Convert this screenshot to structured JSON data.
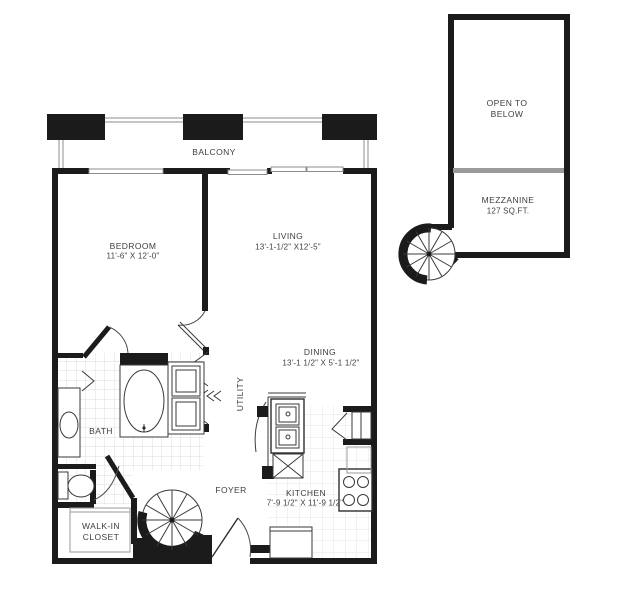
{
  "plan": {
    "rooms": {
      "balcony": {
        "label": "BALCONY"
      },
      "bedroom": {
        "label": "BEDROOM",
        "dims": "11'-6\" X 12'-0\""
      },
      "living": {
        "label": "LIVING",
        "dims": "13'-1-1/2\" X12'-5\""
      },
      "dining": {
        "label": "DINING",
        "dims": "13'-1 1/2\" X 5'-1 1/2\""
      },
      "utility": {
        "label": "UTILITY"
      },
      "bath": {
        "label": "BATH"
      },
      "foyer": {
        "label": "FOYER"
      },
      "kitchen": {
        "label": "KITCHEN",
        "dims": "7'-9 1/2\" X 11'-9 1/2\""
      },
      "walk_in_closet": {
        "label_line1": "WALK-IN",
        "label_line2": "CLOSET"
      },
      "open_to_below": {
        "label_line1": "OPEN TO",
        "label_line2": "BELOW"
      },
      "mezzanine": {
        "label": "MEZZANINE",
        "area": "127 SQ.FT."
      }
    },
    "colors": {
      "wall": "#1b1b1b",
      "window_line": "#8d8d8d",
      "tile_line": "#dcdcdc",
      "kitchen_tile_line": "#e6e6e6",
      "divider": "#9a9a9a",
      "text": "#3e3e3e",
      "bg": "#ffffff"
    }
  }
}
